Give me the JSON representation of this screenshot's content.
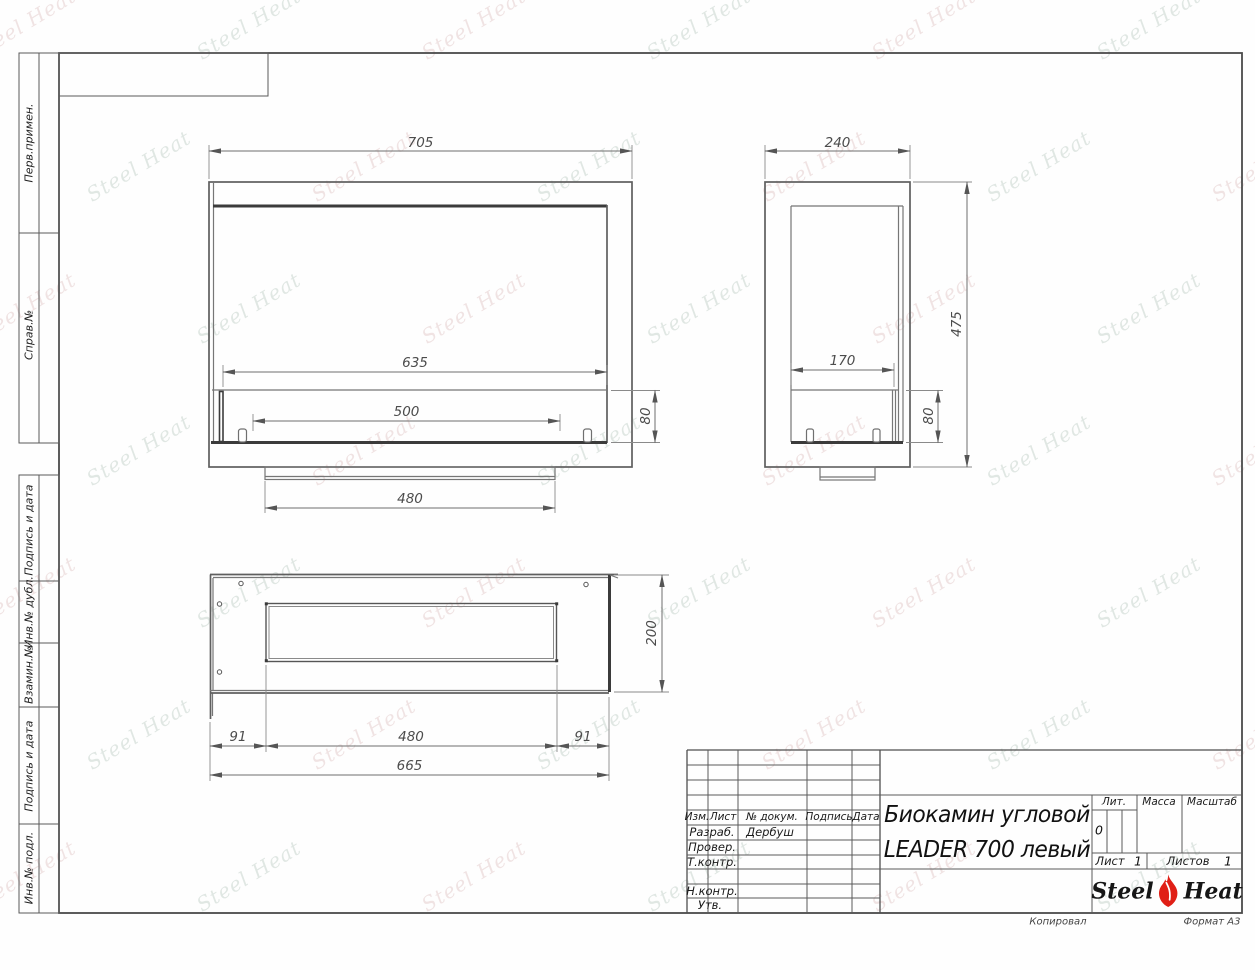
{
  "watermark": {
    "text": "Steel Heat",
    "color_a": "#a9bdb1",
    "color_b": "#d6b2b2"
  },
  "frame": {
    "sidebar_labels": [
      {
        "label": "Перв.примен."
      },
      {
        "label": "Справ.№"
      },
      {
        "label": "Подпись и дата"
      },
      {
        "label": "Инв.№ дубл."
      },
      {
        "label": "Взамин.№"
      },
      {
        "label": "Подпись и дата"
      },
      {
        "label": "Инв.№ подл."
      }
    ],
    "copied_label": "Копировал",
    "format_label": "Формат А3"
  },
  "drawing": {
    "front": {
      "width": "705",
      "glass_width": "635",
      "burner_width": "500",
      "burner_height": "80",
      "base_width": "480"
    },
    "side": {
      "depth": "240",
      "height": "475",
      "burner_depth": "170",
      "burner_height": "80"
    },
    "plan": {
      "depth": "200",
      "left_margin": "91",
      "opening_width": "480",
      "right_margin": "91",
      "total_width": "665"
    }
  },
  "title_block": {
    "rev_header": {
      "izm": "Изм.",
      "list": "Лист",
      "doc": "№ докум.",
      "sign": "Подпись",
      "date": "Дата"
    },
    "roles": [
      {
        "label": "Разраб.",
        "name": "Дербуш"
      },
      {
        "label": "Провер.",
        "name": ""
      },
      {
        "label": "Т.контр.",
        "name": ""
      },
      {
        "label": "Н.контр.",
        "name": ""
      },
      {
        "label": "Утв.",
        "name": ""
      }
    ],
    "title_line1": "Биокамин угловой",
    "title_line2": "LEADER 700 левый",
    "lit_label": "Лит.",
    "lit_value": "0",
    "mass_label": "Масса",
    "scale_label": "Масштаб",
    "sheet_label": "Лист",
    "sheet_number": "1",
    "sheets_label": "Листов",
    "sheets_total": "1",
    "logo": {
      "word1": "Steel",
      "word2": "Heat"
    }
  }
}
